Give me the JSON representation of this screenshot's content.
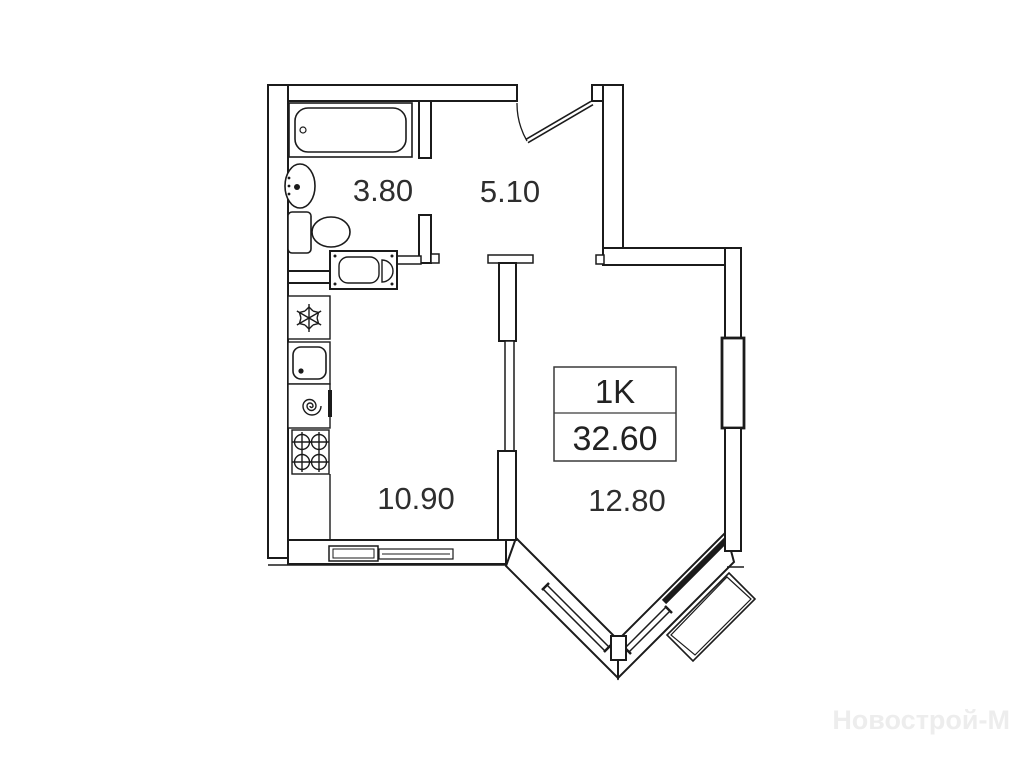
{
  "plan": {
    "unit": {
      "type": "1K",
      "total_area": "32.60"
    },
    "rooms": {
      "bathroom": {
        "name": "bathroom",
        "area": "3.80"
      },
      "hallway": {
        "name": "hallway",
        "area": "5.10"
      },
      "kitchen": {
        "name": "kitchen-living",
        "area": "10.90"
      },
      "room": {
        "name": "room",
        "area": "12.80"
      }
    },
    "watermark": "Новострой-М",
    "colors": {
      "line": "#1b1b1b",
      "label": "#2e2e2e",
      "unit_box_border": "#3a3a3a",
      "watermark": "#ededed",
      "background": "#ffffff"
    },
    "icons": {
      "bathtub": "bathtub-icon",
      "bath_sink": "sink-icon",
      "toilet": "toilet-icon",
      "washing_machine": "washing-machine-icon",
      "fridge": "snowflake-icon",
      "kitchen_sink": "kitchen-sink-icon",
      "water_heater": "spiral-icon",
      "stove": "stove-burners-icon",
      "entrance_door": "door-swing-icon",
      "window": "window-icon",
      "balcony": "balcony-icon"
    }
  }
}
